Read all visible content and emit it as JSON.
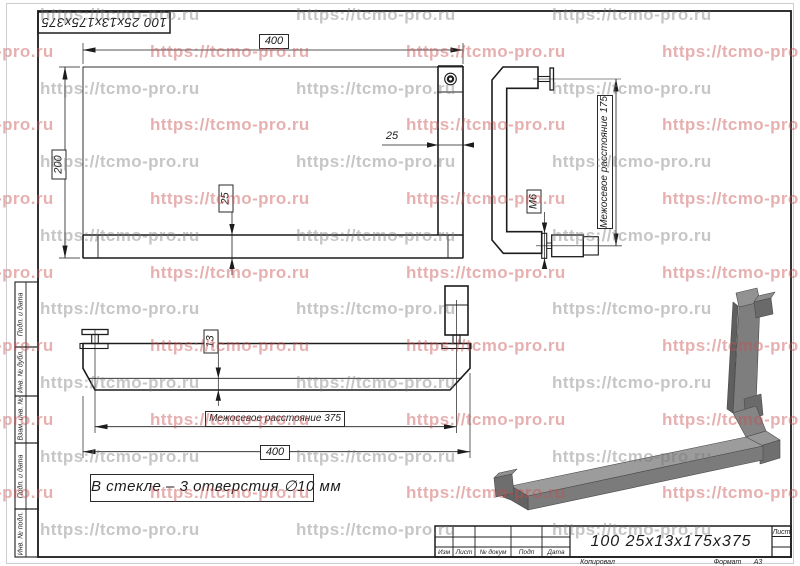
{
  "watermark": {
    "text": "https://tcmo-pro.ru",
    "gray_color": "rgba(120,120,120,0.42)",
    "red_color": "rgba(200,80,80,0.45)"
  },
  "stamp_top": {
    "designation": "100 25x13x175x375"
  },
  "views": {
    "top": {
      "dim_width": "400",
      "dim_height": "200",
      "dim_post_width": "25",
      "dim_bar_height": "25"
    },
    "side": {
      "dim_thread": "M6",
      "dim_axes": "Межосевое расстояние 175"
    },
    "front": {
      "dim_thickness": "13",
      "dim_axes": "Межосевое расстояние 375",
      "dim_width": "400"
    }
  },
  "note": "В стекле – 3 отверстия ∅10 мм",
  "title_block": {
    "designation": "100 25x13x175x375",
    "col_izm": "Изм",
    "col_list": "Лист",
    "col_doc": "№ докум",
    "col_podp": "Подп",
    "col_data": "Дата",
    "sheet_label": "Лист",
    "copied_label": "Копировал",
    "format_label": "Формат",
    "format_value": "А3"
  },
  "sidebar": {
    "items": [
      {
        "label": "Подп. и дата"
      },
      {
        "label": "Инв. № дубл."
      },
      {
        "label": "Взам. инв. №"
      },
      {
        "label": "Подп. и дата"
      },
      {
        "label": "Инв. № подл."
      }
    ]
  }
}
